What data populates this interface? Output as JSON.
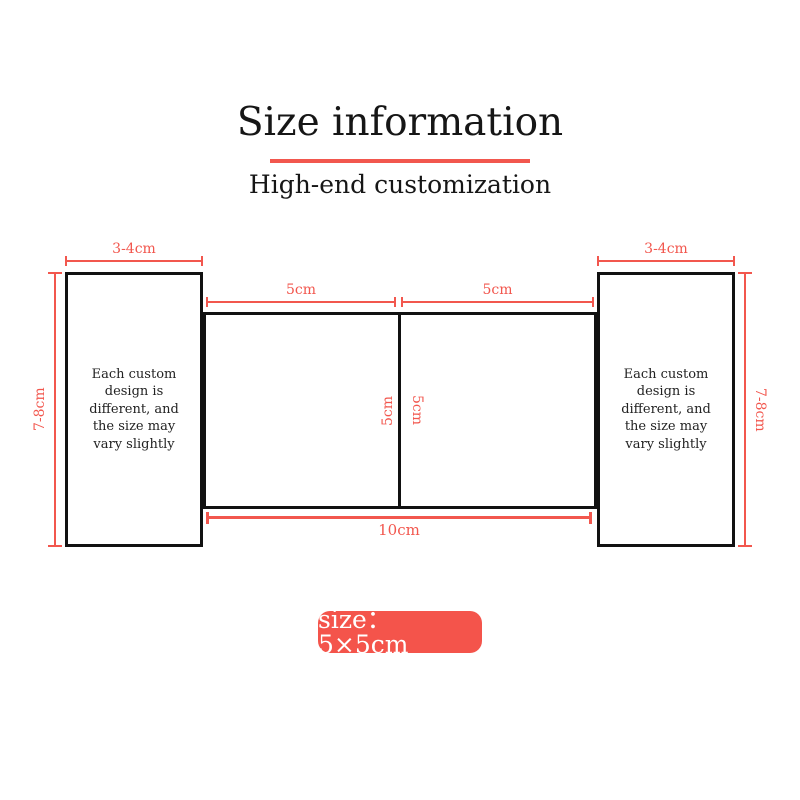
{
  "title": "Size information",
  "subtitle": "High-end customization",
  "colors": {
    "accent": "#f2574e",
    "badge_background": "#f4544b",
    "outline": "#111111"
  },
  "diagram": {
    "left_panel": {
      "top_dim": "3-4cm",
      "side_dim": "7-8cm",
      "note": "Each custom\ndesign is\ndifferent, and\nthe size may\nvary slightly"
    },
    "right_panel": {
      "top_dim": "3-4cm",
      "side_dim": "7-8cm",
      "note": "Each custom\ndesign is\ndifferent, and\nthe size may\nvary slightly"
    },
    "center": {
      "left_square_top_dim": "5cm",
      "right_square_top_dim": "5cm",
      "left_square_side_dim": "5cm",
      "right_square_side_dim": "5cm",
      "bottom_dim": "10cm"
    }
  },
  "badge": {
    "label": "size：5×5cm"
  }
}
